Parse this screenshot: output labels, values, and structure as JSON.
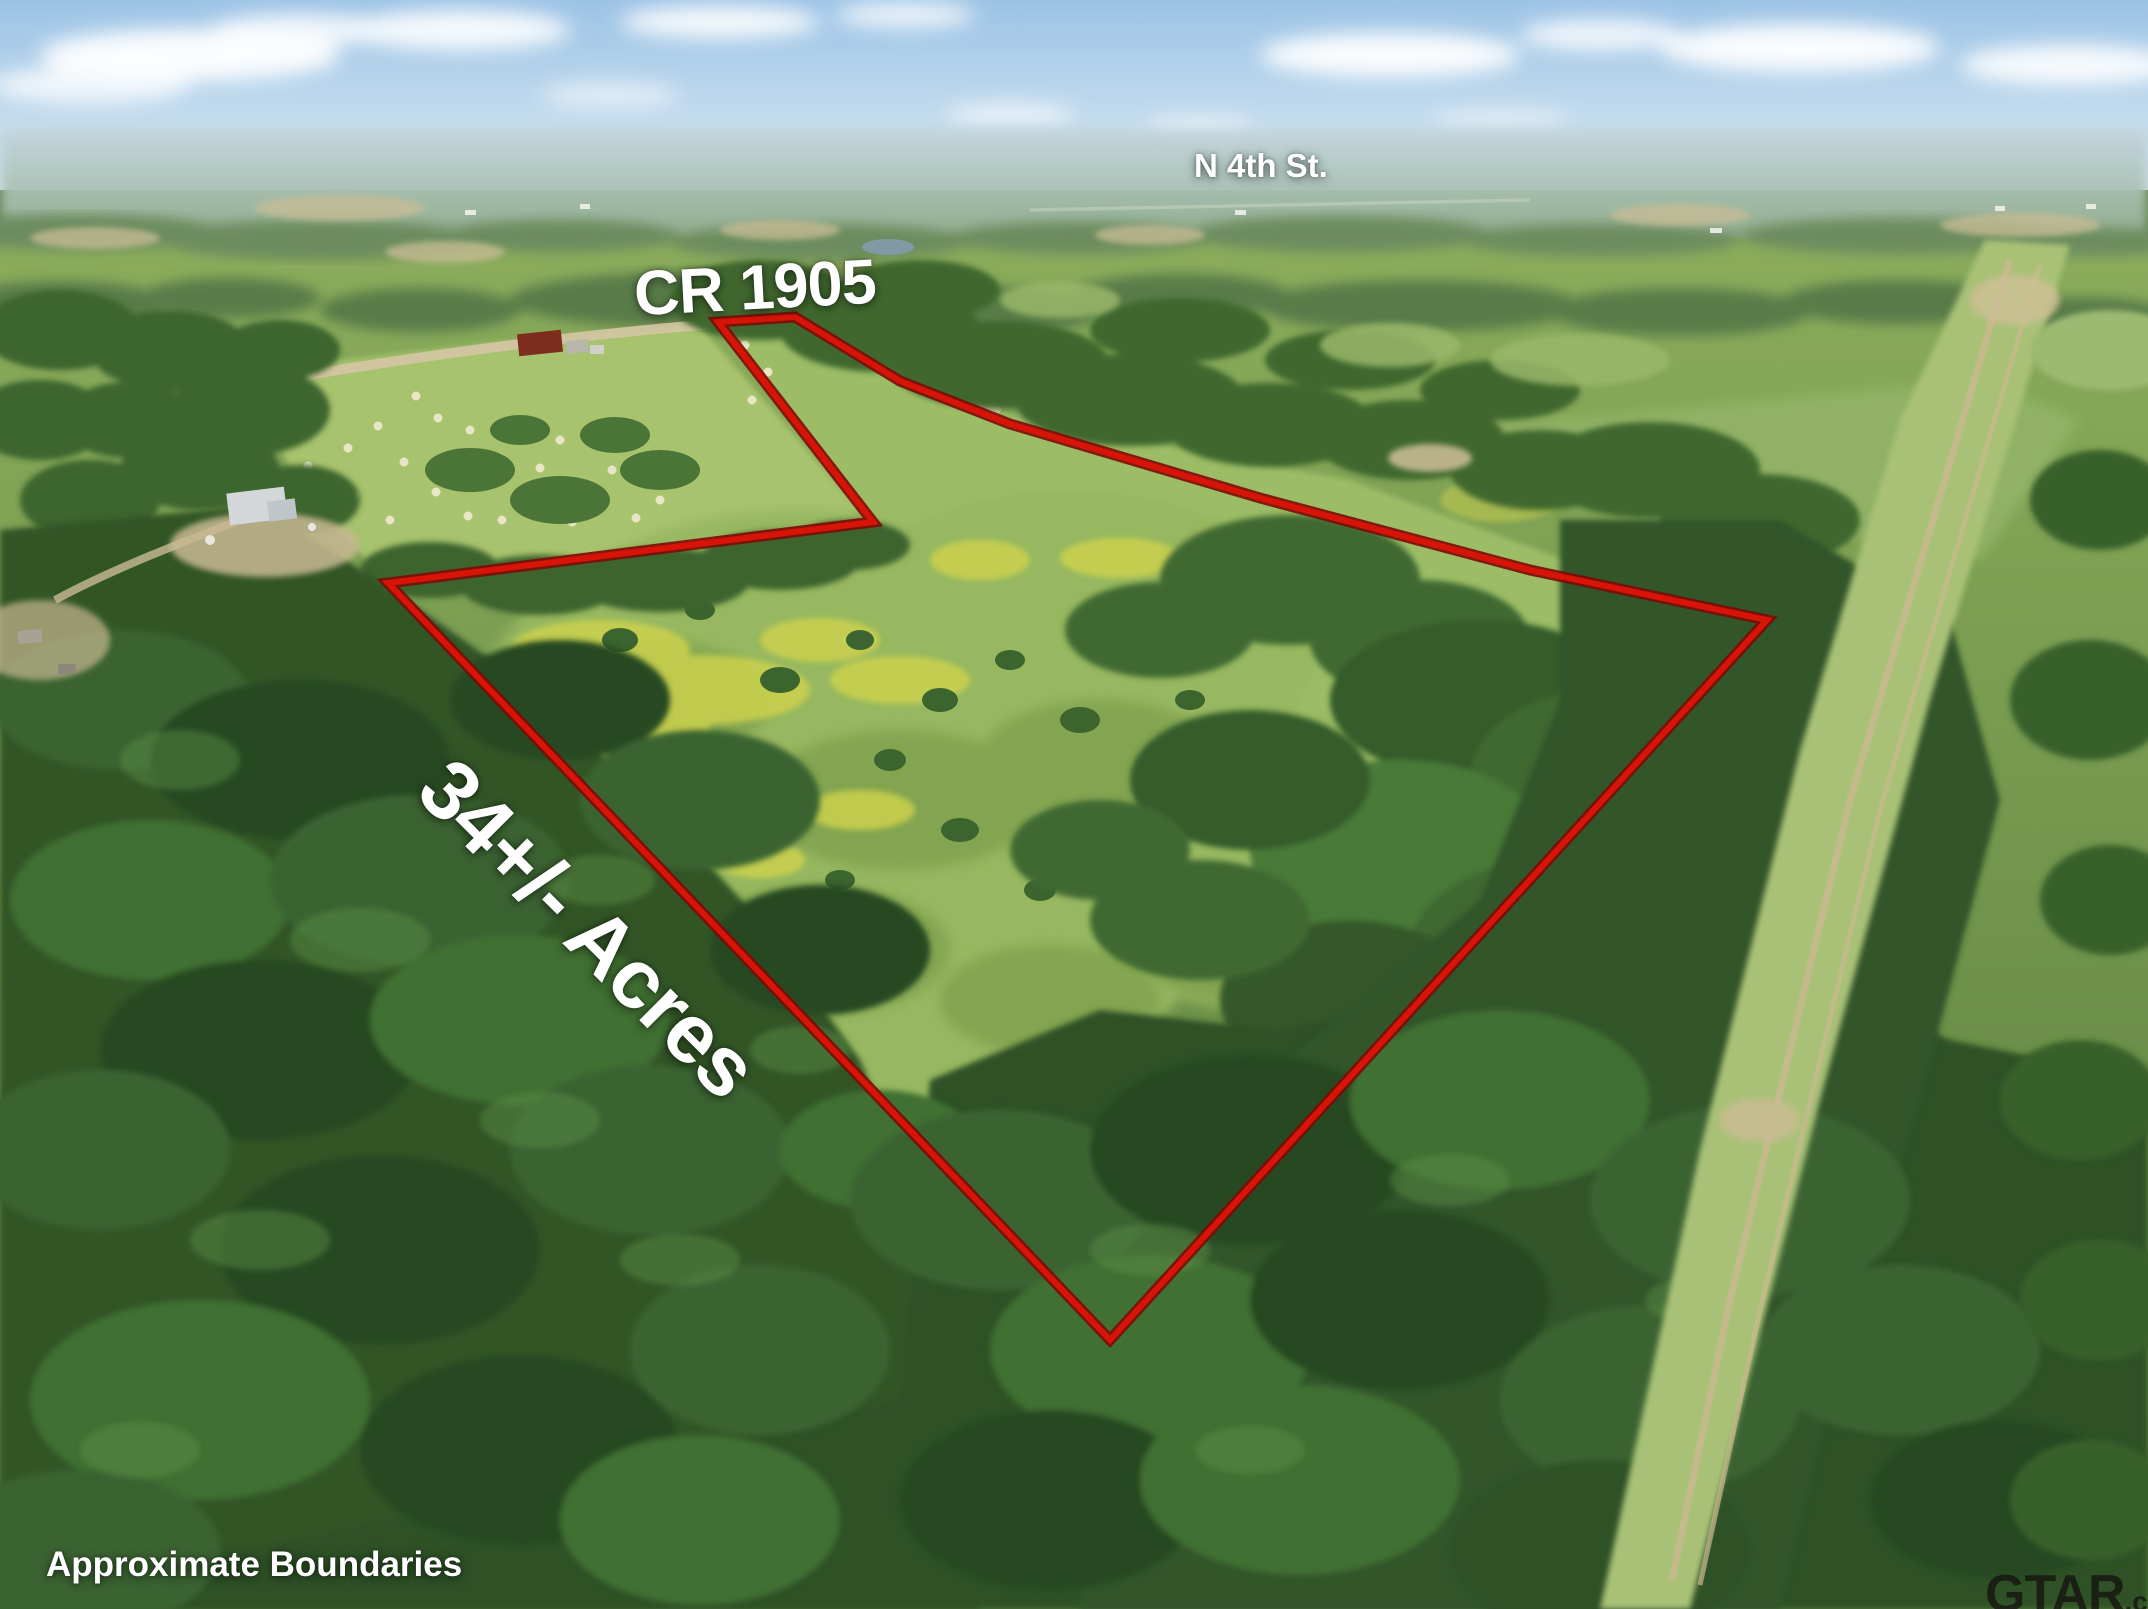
{
  "labels": {
    "street": "N 4th St.",
    "road": "CR 1905",
    "acreage": "34+/- Acres",
    "disclaimer": "Approximate Boundaries"
  },
  "watermark": {
    "brand": "GTAR",
    "suffix": ".com"
  },
  "boundary": {
    "points": "718,322 795,317 900,381 1010,424 1260,498 1530,570 1767,620 1110,1340 388,583 873,522",
    "color": "#d81408",
    "outline_color": "#7d0a04"
  },
  "scene": {
    "sky_top": "#9cc3e5",
    "sky_bottom": "#d9e9f3",
    "pasture_green": "#a7c36d",
    "meadow_green": "#97b860",
    "forest_green": "#2e5125",
    "dirt_tan": "#c9ba93",
    "cloud_white": "#ffffff"
  }
}
